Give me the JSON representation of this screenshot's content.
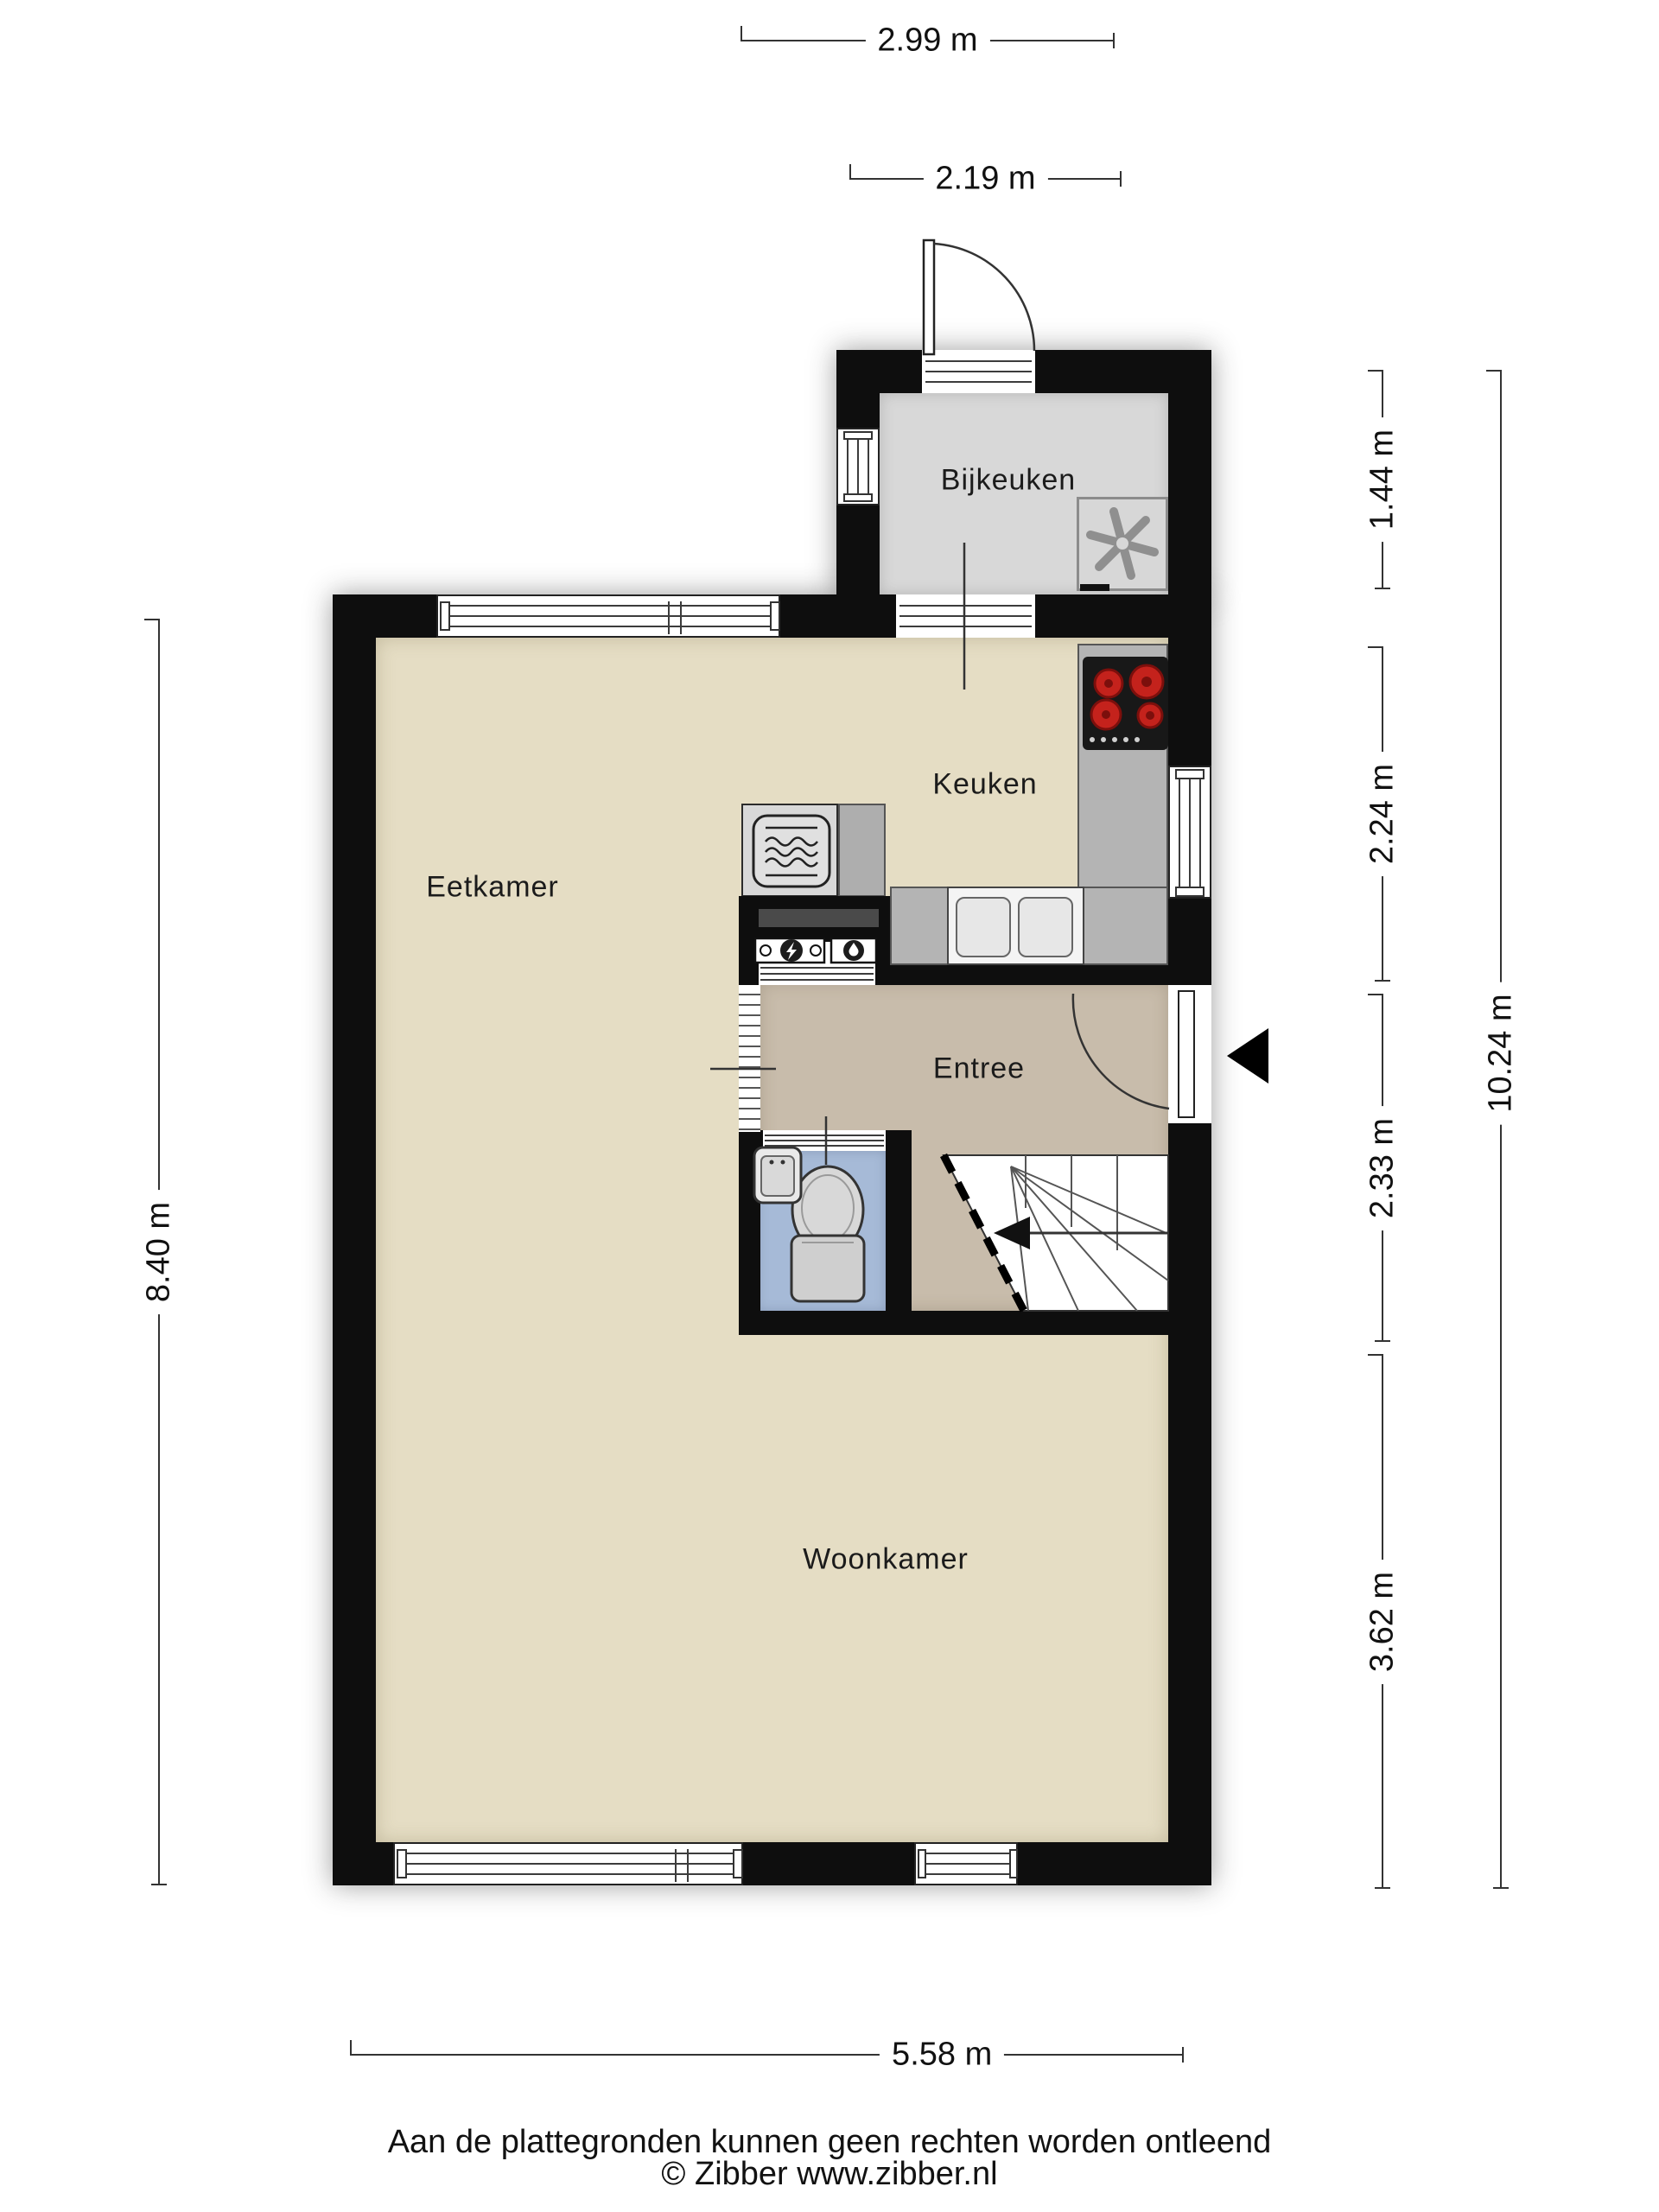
{
  "floorplan": {
    "rooms": {
      "bijkeuken": "Bijkeuken",
      "keuken": "Keuken",
      "eetkamer": "Eetkamer",
      "entree": "Entree",
      "woonkamer": "Woonkamer"
    },
    "dimensions": {
      "top_width": "2.99 m",
      "backdoor_width": "2.19 m",
      "right_bijkeuken": "1.44 m",
      "right_keuken": "2.24 m",
      "right_entree": "2.33 m",
      "right_woonkamer": "3.62 m",
      "right_total": "10.24 m",
      "left_height": "8.40 m",
      "bottom_width": "5.58 m"
    },
    "footer": {
      "disclaimer": "Aan de plattegronden kunnen geen rechten worden ontleend",
      "credit": "© Zibber www.zibber.nl"
    },
    "icons": {
      "entrance-arrow-icon": "solid black triangle pointing left at front door",
      "stairs-down-arrow-icon": "arrow on staircase pointing left",
      "washing-machine-icon": "square appliance with six-blade fan glyph",
      "stove-icon": "black cooktop with four red burners",
      "microwave-icon": "rounded square with heat-wave lines",
      "electric-meter-icon": "meter box with lightning bolt in circle",
      "water-heater-icon": "meter box with water drop in circle",
      "toilet-icon": "toilet bowl with cistern",
      "hand-basin-icon": "small corner wash basin",
      "door-swing-arc": "quarter-circle door swing symbol"
    },
    "colors": {
      "wall": "#0e0e0e",
      "floor_living": "#e5ddc4",
      "floor_entree": "#c8bcab",
      "floor_wc": "#a6bad7",
      "floor_bijkeuken": "#d8d8d8",
      "counter": "#b4b4b4",
      "burner_red": "#c4221c"
    }
  }
}
